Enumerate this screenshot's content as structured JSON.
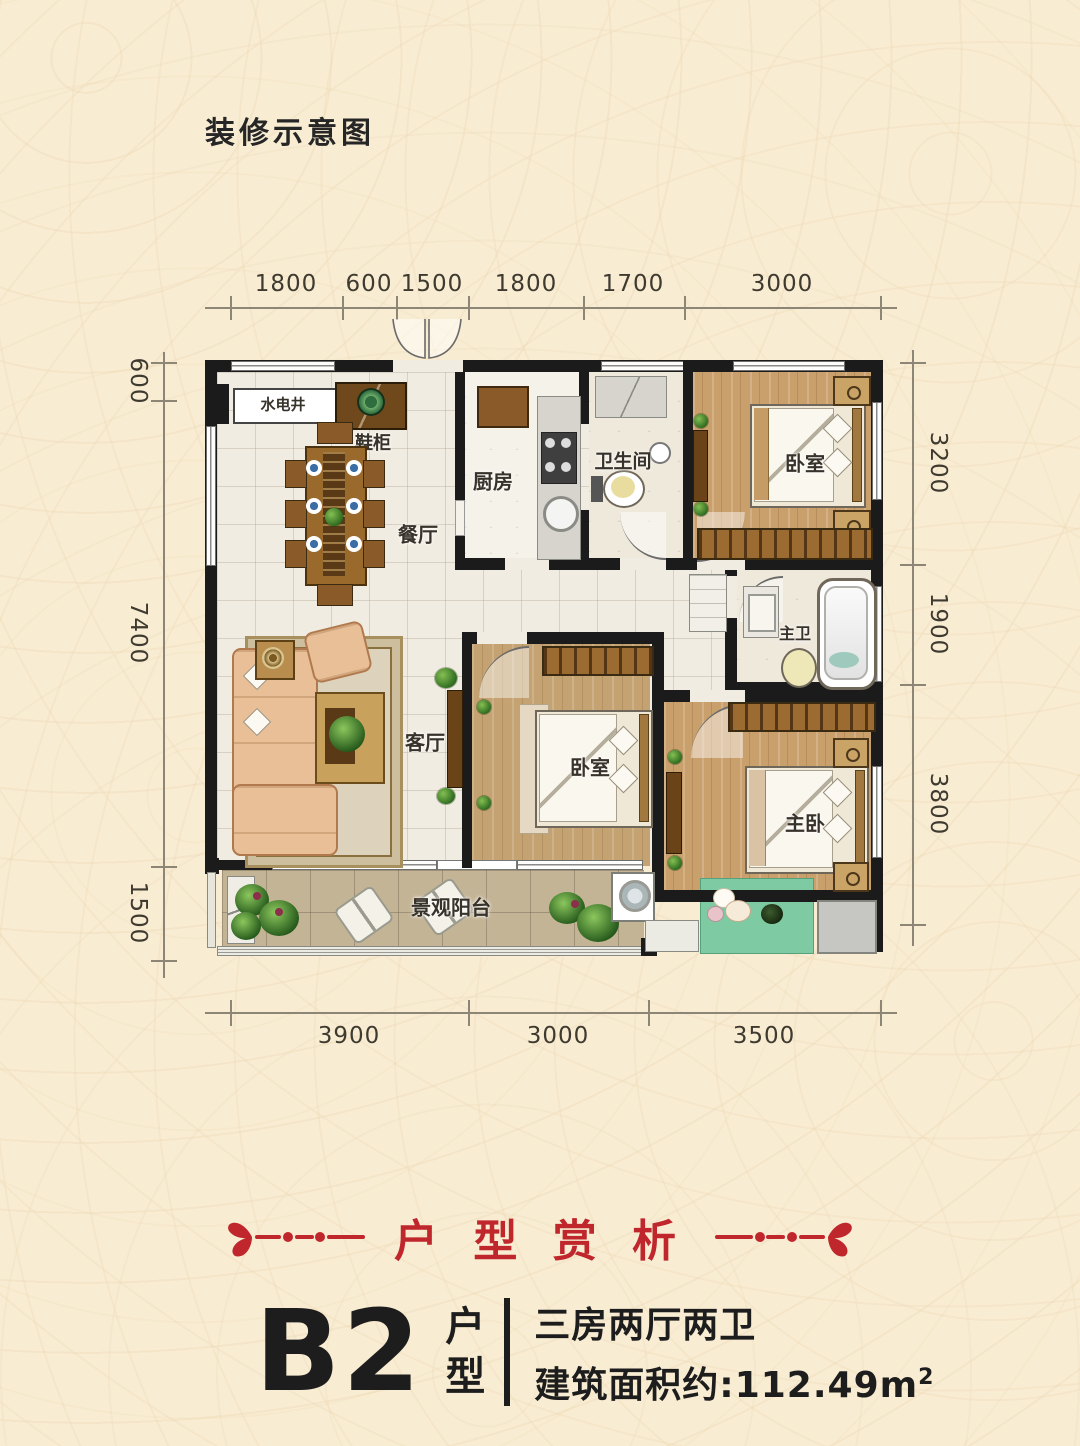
{
  "page_title": "装修示意图",
  "floorplan": {
    "dims": {
      "top": [
        "1800",
        "600",
        "1500",
        "1800",
        "1700",
        "3000"
      ],
      "bottom": [
        "3900",
        "3000",
        "3500"
      ],
      "left": [
        "600",
        "7400",
        "1500"
      ],
      "right": [
        "3200",
        "1900",
        "3800"
      ]
    },
    "rooms": {
      "shaft": "水电井",
      "shoe_cabinet": "鞋柜",
      "kitchen": "厨房",
      "bathroom": "卫生间",
      "bedroom_top": "卧室",
      "dining": "餐厅",
      "master_bath": "主卫",
      "living": "客厅",
      "bedroom_mid": "卧室",
      "master_bedroom": "主卧",
      "balcony": "景观阳台"
    }
  },
  "section_title": "户 型 赏 析",
  "unit": {
    "code": "B2",
    "type_label": "户型",
    "layout": "三房两厅两卫",
    "area": "建筑面积约:112.49m",
    "area_sup": "2"
  },
  "colors": {
    "accent_red": "#c0272d",
    "background": "#f8ecd2",
    "wall": "#1b1b1b"
  }
}
